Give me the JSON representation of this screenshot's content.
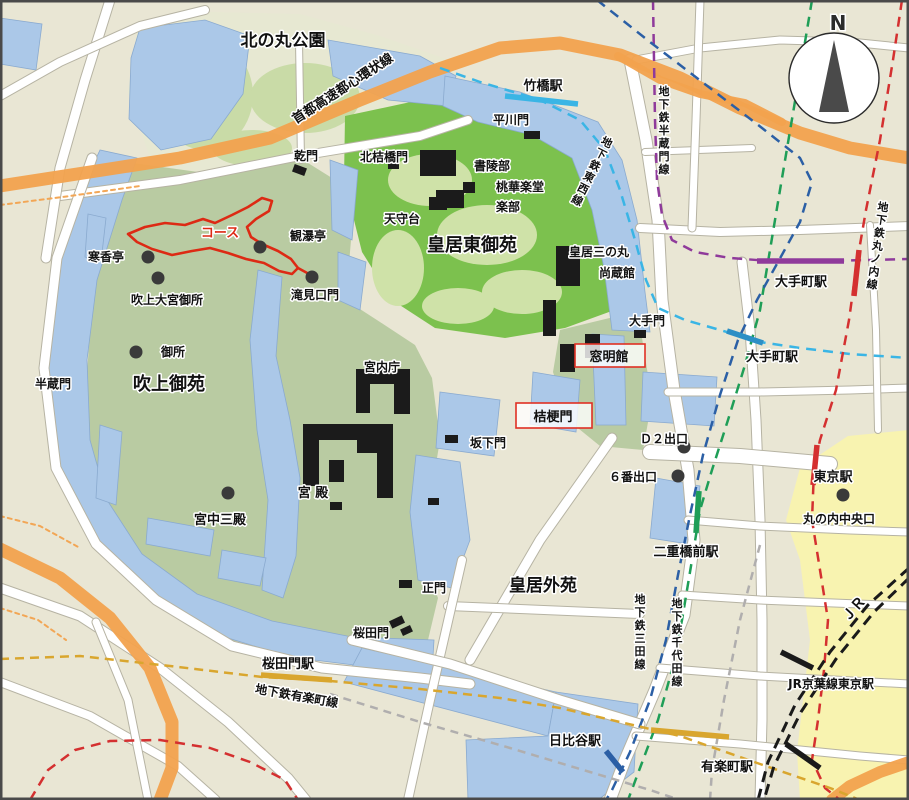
{
  "compass_label": "N",
  "palette": {
    "background": "#e9e6d4",
    "park_pale": "#e7e8d2",
    "park_patch": "#c9dba7",
    "park_sage": "#b9cba2",
    "park_green": "#7cc14e",
    "park_light": "#cfe2a8",
    "water": "#abc8e8",
    "water_edge": "#8aaacf",
    "road_fill": "#ffffff",
    "road_edge": "#b6b3a3",
    "expressway": "#f2a24e",
    "station_yellow": "#f8f3b0",
    "building": "#1b1b1b",
    "dot": "#3a3a3a",
    "course_red": "#dd2a14",
    "box_red": "#e03024",
    "label": "#111111",
    "halo": "#ffffff",
    "border": "#4a4a4a"
  },
  "labels": [
    {
      "id": "kitanomaru-park-label",
      "text": "北の丸公園"
    },
    {
      "id": "higashi-gyoen-label",
      "text": "皇居東御苑"
    },
    {
      "id": "fukiage-gyoen-label",
      "text": "吹上御苑"
    },
    {
      "id": "kokyo-gaien-label",
      "text": "皇居外苑"
    },
    {
      "id": "inui-mon-label",
      "text": "乾門"
    },
    {
      "id": "kitahanebashi-mon-label",
      "text": "北桔橋門"
    },
    {
      "id": "hirakawa-mon-label",
      "text": "平川門"
    },
    {
      "id": "shoryobu-label",
      "text": "書陵部"
    },
    {
      "id": "tokagakudo-label",
      "text": "桃華楽堂"
    },
    {
      "id": "gakubu-label",
      "text": "楽部"
    },
    {
      "id": "tenshudai-label",
      "text": "天守台"
    },
    {
      "id": "sannomaru-label",
      "text": "皇居三の丸"
    },
    {
      "id": "shozokan-label",
      "text": "尚蔵館"
    },
    {
      "id": "kanbakutei-label",
      "text": "観瀑亭"
    },
    {
      "id": "kankotei-label",
      "text": "寒香亭"
    },
    {
      "id": "fukiage-omiya-label",
      "text": "吹上大宮御所"
    },
    {
      "id": "takimiguchi-mon-label",
      "text": "滝見口門"
    },
    {
      "id": "gosho-label",
      "text": "御所"
    },
    {
      "id": "hanzomon-label",
      "text": "半蔵門"
    },
    {
      "id": "kunaicho-label",
      "text": "宮内庁"
    },
    {
      "id": "kyuden-label",
      "text": "宮 殿"
    },
    {
      "id": "kyuchu-sanden-label",
      "text": "宮中三殿"
    },
    {
      "id": "sakashita-mon-label",
      "text": "坂下門"
    },
    {
      "id": "otemon-label",
      "text": "大手門"
    },
    {
      "id": "seimon-label",
      "text": "正門"
    },
    {
      "id": "sakurada-mon-label",
      "text": "桜田門"
    },
    {
      "id": "marunouchi-chuo-label",
      "text": "丸の内中央口"
    },
    {
      "id": "takebashi-station-label",
      "text": "竹橋駅"
    },
    {
      "id": "otemachi-station-1-label",
      "text": "大手町駅"
    },
    {
      "id": "otemachi-station-2-label",
      "text": "大手町駅"
    },
    {
      "id": "tokyo-station-label",
      "text": "東京駅"
    },
    {
      "id": "nijubashimae-station-label",
      "text": "二重橋前駅"
    },
    {
      "id": "sakuradamon-station-label",
      "text": "桜田門駅"
    },
    {
      "id": "hibiya-station-label",
      "text": "日比谷駅"
    },
    {
      "id": "yurakucho-station-label",
      "text": "有楽町駅"
    },
    {
      "id": "jr-keiyo-label",
      "text": "JR京葉線東京駅"
    },
    {
      "id": "jr-label",
      "text": "ＪＲ"
    },
    {
      "id": "d2-exit-label",
      "text": "Ｄ２出口"
    },
    {
      "id": "exit-6-label",
      "text": "６番出口"
    },
    {
      "id": "course-label",
      "text": "コース",
      "color": "#dd2a14"
    },
    {
      "id": "shuto-expressway-label",
      "text": "首都高速都心環状線"
    },
    {
      "id": "yurakucho-line-label",
      "text": "地下鉄有楽町線"
    },
    {
      "id": "hanzomon-line-label",
      "text": "地下鉄半蔵門線"
    },
    {
      "id": "tozai-line-label",
      "text": "地下鉄東西線"
    },
    {
      "id": "marunouchi-line-label",
      "text": "地下鉄丸ノ内線"
    },
    {
      "id": "mita-line-label",
      "text": "地下鉄三田線"
    },
    {
      "id": "chiyoda-line-label",
      "text": "地下鉄千代田線"
    }
  ],
  "boxed_labels": [
    {
      "id": "somei-kan-label",
      "text": "窓明館"
    },
    {
      "id": "kikyo-mon-label",
      "text": "桔梗門"
    }
  ],
  "lines": [
    {
      "id": "shuto-expressway",
      "label": "首都高速都心環状線",
      "color": "#f2a24e",
      "kind": "expressway"
    },
    {
      "id": "tozai-line",
      "label": "地下鉄東西線",
      "color": "#3ab5e5",
      "kind": "subway"
    },
    {
      "id": "hanzomon-line",
      "label": "地下鉄半蔵門線",
      "color": "#8f3a9b",
      "kind": "subway"
    },
    {
      "id": "marunouchi-line",
      "label": "地下鉄丸ノ内線",
      "color": "#d43030",
      "kind": "subway"
    },
    {
      "id": "chiyoda-line",
      "label": "地下鉄千代田線",
      "color": "#1f9e57",
      "kind": "subway"
    },
    {
      "id": "mita-line",
      "label": "地下鉄三田線",
      "color": "#2b5fa5",
      "kind": "subway"
    },
    {
      "id": "yurakucho-line",
      "label": "地下鉄有楽町線",
      "color": "#d9a62e",
      "kind": "subway"
    },
    {
      "id": "jr-line",
      "label": "JR",
      "color": "#1a1a1a",
      "kind": "rail"
    },
    {
      "id": "local-line",
      "label": "",
      "color": "#b0aeae",
      "kind": "rail"
    }
  ],
  "stations": [
    {
      "id": "takebashi-station-marker",
      "color": "#3ab5e5"
    },
    {
      "id": "otemachi-hanzomon-marker",
      "color": "#8f3a9b"
    },
    {
      "id": "otemachi-marunouchi-marker",
      "color": "#d43030"
    },
    {
      "id": "otemachi-tozai-marker",
      "color": "#2d8fc5"
    },
    {
      "id": "nijubashimae-station-marker",
      "color": "#1f9e57"
    },
    {
      "id": "hibiya-mita-marker",
      "color": "#2b5fa5"
    },
    {
      "id": "hibiya-yurakucho-marker",
      "color": "#d9a62e"
    },
    {
      "id": "sakuradamon-station-marker",
      "color": "#d9a62e"
    },
    {
      "id": "tokyo-marunouchi-marker",
      "color": "#d43030"
    },
    {
      "id": "jr-keiyo-tokyo-marker",
      "color": "#1a1a1a"
    },
    {
      "id": "jr-yurakucho-marker",
      "color": "#1a1a1a"
    }
  ]
}
